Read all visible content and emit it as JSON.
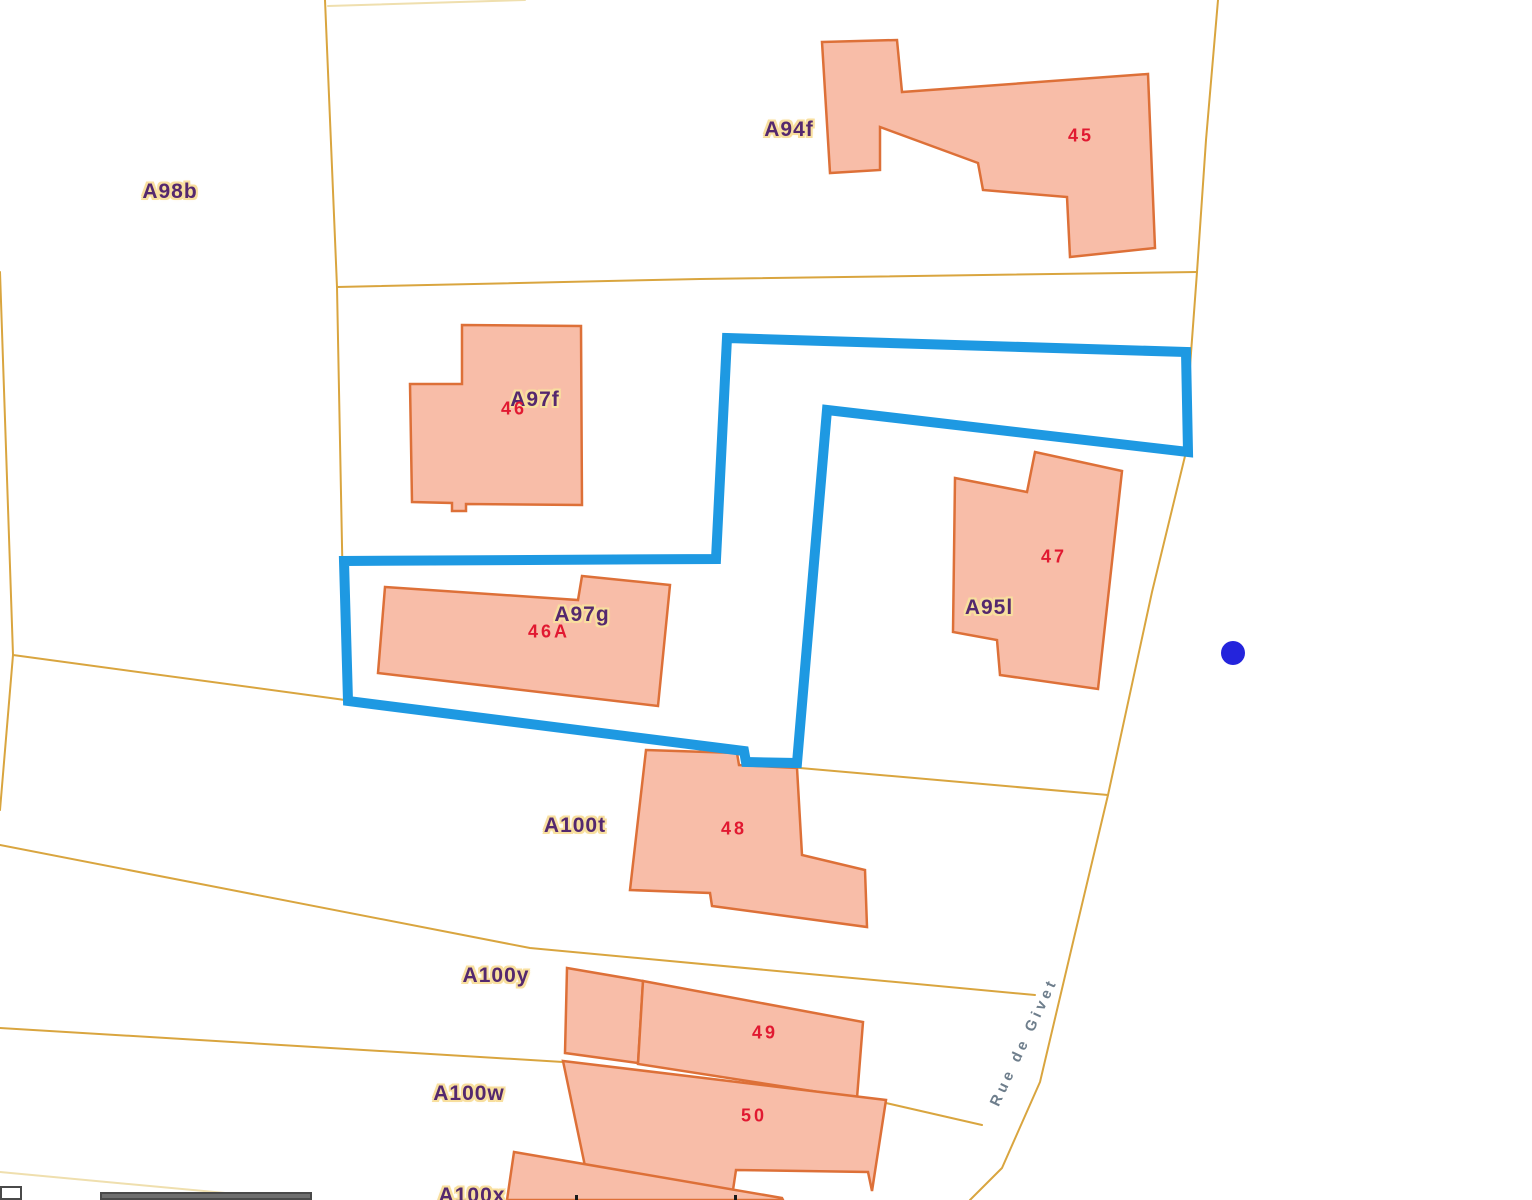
{
  "map": {
    "width": 1532,
    "height": 1200,
    "colors": {
      "background": "#ffffff",
      "parcel_line": "#D9A53F",
      "parcel_line_pale": "#EFDFAE",
      "building_fill": "#F8BDA8",
      "building_stroke": "#DD7038",
      "highlight_blue": "#1E99E2",
      "marker_blue": "#2424DC",
      "parcel_label_text": "#54286E",
      "parcel_label_halo": "#F8DF9E",
      "building_number_text": "#E11931",
      "street_label_text": "#6E7E8C",
      "scalebar_gray": "#6E6E6E",
      "scalebar_border": "#4A4A4A"
    },
    "parcel_lines": [
      {
        "name": "top-edge-line",
        "points": "328,6 525,0",
        "pale": true
      },
      {
        "name": "west-boundary",
        "points": "0,272 13,655 0,810",
        "pale": false
      },
      {
        "name": "north-vertical-boundary",
        "points": "325,0 337,287",
        "pale": false
      },
      {
        "name": "a94f-south-boundary",
        "points": "337,287 700,279 1197,272",
        "pale": false
      },
      {
        "name": "a97f-west-boundary",
        "points": "337,287 345,700",
        "pale": false
      },
      {
        "name": "highlight-parcel-south-boundary",
        "points": "13,655 345,700 744,751 747,762 800,768 1108,795",
        "pale": false
      },
      {
        "name": "rue-de-givet-west-edge",
        "points": "1218,0 1206,140 1197,272 1189,380 1186,452 1152,592 1108,795 1074,938 1040,1082 1002,1168 970,1200",
        "pale": false
      },
      {
        "name": "a100t-south-boundary",
        "points": "0,845 530,948 1035,995",
        "pale": false
      },
      {
        "name": "a100y-south-boundary",
        "points": "0,1028 563,1062 886,1103 982,1125",
        "pale": false
      },
      {
        "name": "a100w-south-boundary",
        "points": "0,1172 300,1200",
        "pale": true
      }
    ],
    "buildings": [
      {
        "id": "building-45",
        "points": "822,42 897,40 902,92 1148,74 1155,248 1070,257 1067,197 983,190 978,163 880,127 880,170 830,173"
      },
      {
        "id": "building-46",
        "points": "410,384 462,384 462,325 581,326 582,505 466,504 466,511 452,511 452,503 412,502"
      },
      {
        "id": "building-46A",
        "points": "385,587 578,600 582,576 670,585 658,706 378,673"
      },
      {
        "id": "building-47",
        "points": "955,478 1027,492 1035,452 1122,471 1098,689 1000,675 997,640 953,632"
      },
      {
        "id": "building-48",
        "points": "646,750 737,753 739,765 797,768 802,855 865,870 867,927 712,906 710,893 630,890"
      },
      {
        "id": "building-49-left",
        "points": "567,968 643,981 638,1063 565,1053"
      },
      {
        "id": "building-49-main",
        "points": "643,981 863,1022 857,1098 638,1064"
      },
      {
        "id": "building-50",
        "points": "563,1061 886,1100 872,1191 868,1172 736,1170 733,1190 590,1190"
      },
      {
        "id": "building-bottom-partial",
        "points": "514,1152 782,1198 783,1200 507,1200"
      }
    ],
    "highlight_parcel": {
      "points": "727,338 1186,352 1188,452 827,410 797,763 746,762 744,751 348,701 344,561 716,559",
      "stroke_width": 10
    },
    "marker": {
      "cx": 1233,
      "cy": 653,
      "r": 12
    },
    "parcel_labels": [
      {
        "text": "A98b",
        "x": 170,
        "y": 192
      },
      {
        "text": "A94f",
        "x": 789,
        "y": 130
      },
      {
        "text": "A97f",
        "x": 535,
        "y": 400
      },
      {
        "text": "A97g",
        "x": 582,
        "y": 615
      },
      {
        "text": "A95l",
        "x": 989,
        "y": 608
      },
      {
        "text": "A100t",
        "x": 575,
        "y": 826
      },
      {
        "text": "A100y",
        "x": 496,
        "y": 976
      },
      {
        "text": "A100w",
        "x": 469,
        "y": 1094
      },
      {
        "text": "A100x",
        "x": 472,
        "y": 1196
      }
    ],
    "building_numbers": [
      {
        "text": "45",
        "x": 1081,
        "y": 136
      },
      {
        "text": "46",
        "x": 514,
        "y": 409
      },
      {
        "text": "46A",
        "x": 549,
        "y": 632
      },
      {
        "text": "47",
        "x": 1054,
        "y": 557
      },
      {
        "text": "48",
        "x": 734,
        "y": 829
      },
      {
        "text": "49",
        "x": 765,
        "y": 1033
      },
      {
        "text": "50",
        "x": 754,
        "y": 1116
      }
    ],
    "street_label": {
      "text": "Rue de Givet",
      "x": 1024,
      "y": 1042,
      "rotation": -65
    },
    "scalebar": {
      "box": {
        "x": 0,
        "y": 1186,
        "w": 22,
        "h": 14
      },
      "bar": {
        "x": 100,
        "y": 1192,
        "w": 212,
        "h": 8
      },
      "ticks": [
        {
          "x": 575,
          "y": 1195,
          "w": 3,
          "h": 5
        },
        {
          "x": 734,
          "y": 1195,
          "w": 3,
          "h": 5
        }
      ]
    }
  }
}
